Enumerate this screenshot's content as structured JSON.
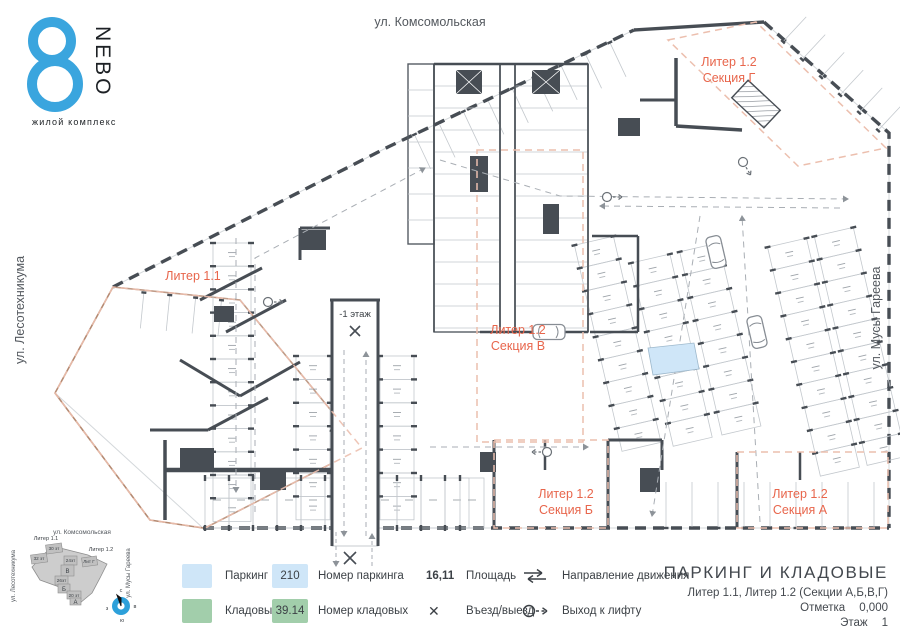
{
  "logo": {
    "name": "NEBO",
    "subtitle": "жилой комплекс"
  },
  "streets": {
    "top": "ул. Комсомольская",
    "left": "ул. Лесотехникума",
    "right": "ул. Мусы Гареева"
  },
  "plan_labels": {
    "liter11": "Литер 1.1",
    "liter12": "Литер 1.2",
    "section_g": "Секция Г",
    "section_v": "Секция В",
    "section_b": "Секция Б",
    "section_a": "Секция А",
    "ramp": "-1 этаж"
  },
  "legend": {
    "parking": "Паркинг",
    "storage": "Кладовые",
    "parking_no_value": "210",
    "parking_no_label": "Номер паркинга",
    "storage_no_value": "39.14",
    "storage_no_label": "Номер кладовых",
    "area_value": "16,11",
    "area_label": "Площадь",
    "entry_symbol": "✕",
    "entry_label": "Въезд/выезд",
    "direction_label": "Направление движения",
    "exit_label": "Выход к лифту"
  },
  "title_block": {
    "title": "ПАРКИНГ И КЛАДОВЫЕ",
    "subtitle": "Литер 1.1, Литер 1.2 (Секции А,Б,В,Г)",
    "mark_label": "Отметка",
    "mark_value": "0,000",
    "floor_label": "Этаж",
    "floor_value": "1"
  },
  "minimap": {
    "liter11": "Литер 1.1",
    "liter12": "Литер 1.2",
    "blocks": [
      "30 эт",
      "32 эт",
      "24эт",
      "Лит Г",
      "В",
      "26эт",
      "Б",
      "20 эт",
      "А"
    ],
    "compass": {
      "n": "с",
      "e": "в",
      "s": "ю",
      "w": "з"
    }
  },
  "colors": {
    "accent": "#e8664c",
    "boundary_dash": "#ecbfae",
    "parking_fill": "#cfe6f8",
    "storage_fill": "#a2ceab",
    "wall": "#474d54",
    "line": "#c3c8cd",
    "aisle": "#a9aeb4",
    "tan": "#b58a72",
    "logo_blue": "#3aa5de",
    "compass_blue": "#2da0da",
    "ink": "#3c4146"
  }
}
